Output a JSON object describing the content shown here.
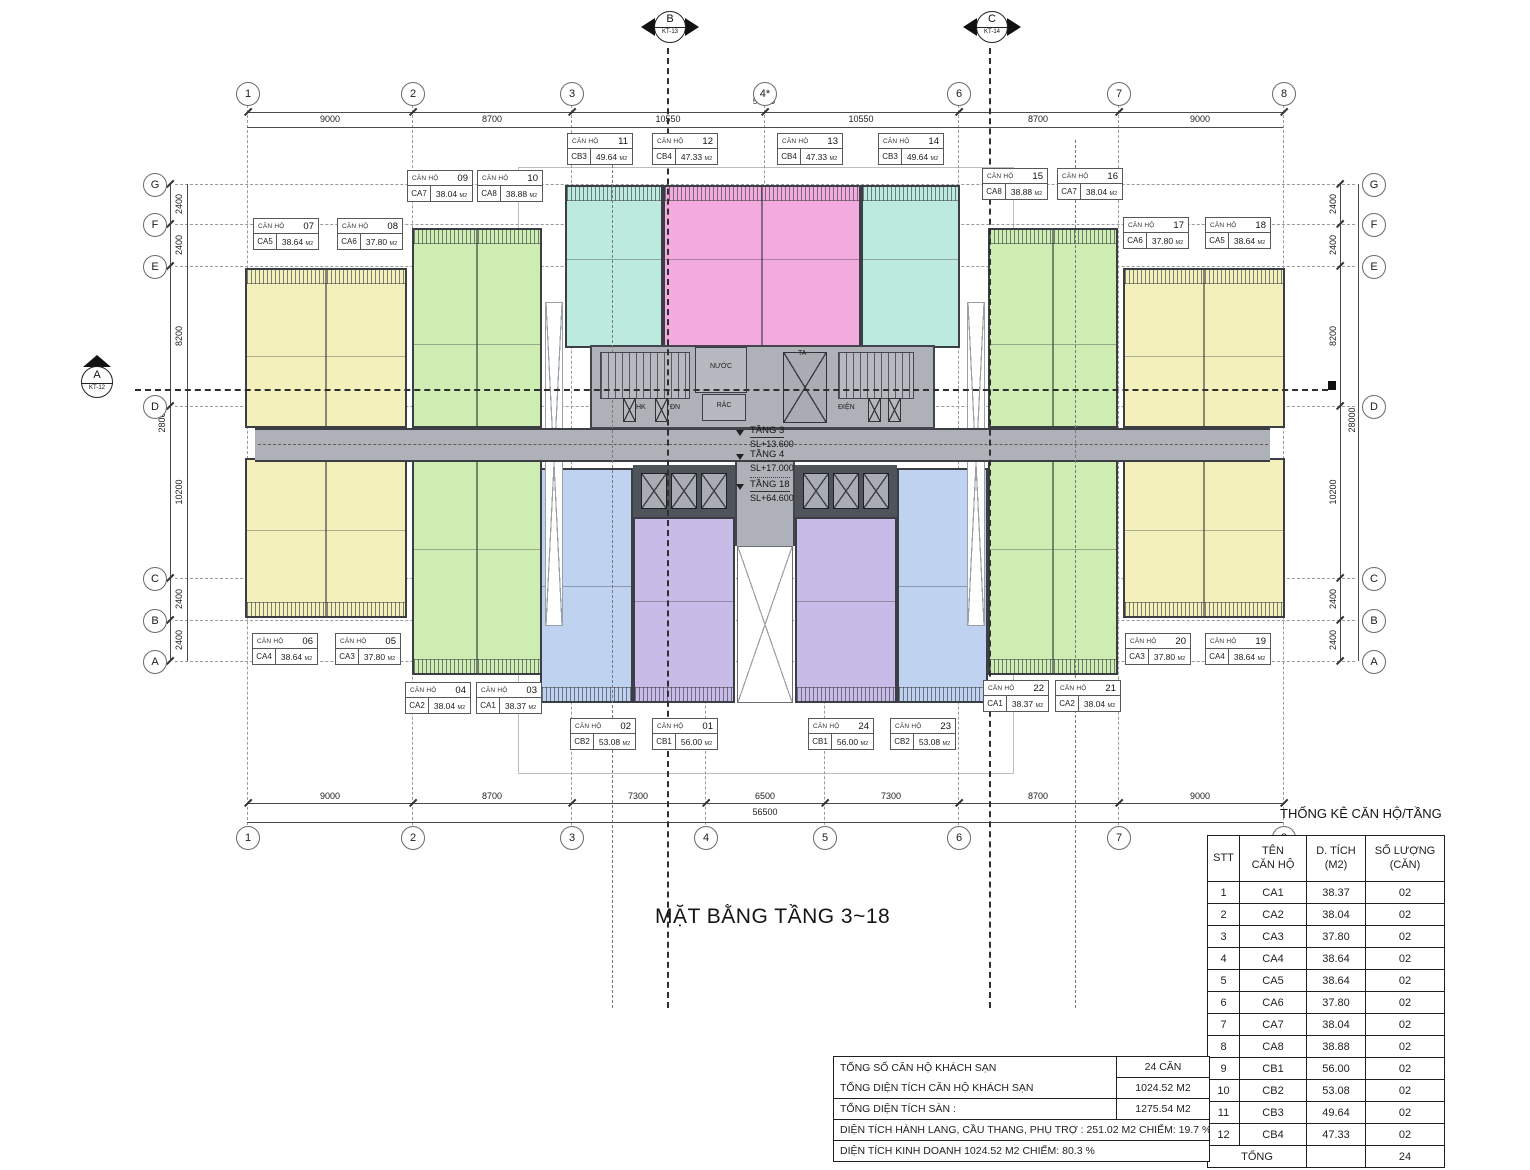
{
  "title": "MẶT BẰNG TẦNG 3~18",
  "section_markers": {
    "b": {
      "label": "B",
      "ref": "KT-13"
    },
    "c": {
      "label": "C",
      "ref": "KT-14"
    },
    "a": {
      "label": "A",
      "ref": "KT-12"
    }
  },
  "grid": {
    "top": [
      "1",
      "2",
      "3",
      "4*",
      "6",
      "7",
      "8"
    ],
    "bottom": [
      "1",
      "2",
      "3",
      "4",
      "5",
      "6",
      "7",
      "8"
    ],
    "left": [
      "G",
      "F",
      "E",
      "D",
      "C",
      "B",
      "A"
    ],
    "right": [
      "G",
      "F",
      "E",
      "D",
      "C",
      "B",
      "A"
    ]
  },
  "dims": {
    "top": [
      "9000",
      "8700",
      "10550",
      "10550",
      "8700",
      "9000"
    ],
    "top_total": "56500",
    "bottom": [
      "9000",
      "8700",
      "7300",
      "6500",
      "7300",
      "8700",
      "9000"
    ],
    "bottom_total": "56500",
    "left": [
      "2400",
      "2400",
      "8200",
      "10200",
      "2400",
      "2400"
    ],
    "left_total": "28000",
    "right": [
      "2400",
      "2400",
      "8200",
      "10200",
      "2400",
      "2400"
    ],
    "right_total": "28000"
  },
  "core": {
    "rooms": {
      "nuoc": "NƯỚC",
      "rac": "RÁC",
      "dn": "ĐN",
      "hk": "HK",
      "dien": "ĐIỆN",
      "ta": "TA"
    },
    "levels": [
      {
        "name": "TẦNG 3",
        "elev": "SL+13.600"
      },
      {
        "name": "TẦNG 4",
        "elev": "SL+17.000"
      },
      {
        "name": "TẦNG 18",
        "elev": "SL+64.600"
      }
    ]
  },
  "apartment_label_prefix": "CĂN HỘ",
  "area_unit": "M2",
  "apartments": [
    {
      "no": "01",
      "code": "CB1",
      "area": "56.00"
    },
    {
      "no": "02",
      "code": "CB2",
      "area": "53.08"
    },
    {
      "no": "03",
      "code": "CA1",
      "area": "38.37"
    },
    {
      "no": "04",
      "code": "CA2",
      "area": "38.04"
    },
    {
      "no": "05",
      "code": "CA3",
      "area": "37.80"
    },
    {
      "no": "06",
      "code": "CA4",
      "area": "38.64"
    },
    {
      "no": "07",
      "code": "CA5",
      "area": "38.64"
    },
    {
      "no": "08",
      "code": "CA6",
      "area": "37.80"
    },
    {
      "no": "09",
      "code": "CA7",
      "area": "38.04"
    },
    {
      "no": "10",
      "code": "CA8",
      "area": "38.88"
    },
    {
      "no": "11",
      "code": "CB3",
      "area": "49.64"
    },
    {
      "no": "12",
      "code": "CB4",
      "area": "47.33"
    },
    {
      "no": "13",
      "code": "CB4",
      "area": "47.33"
    },
    {
      "no": "14",
      "code": "CB3",
      "area": "49.64"
    },
    {
      "no": "15",
      "code": "CA8",
      "area": "38.88"
    },
    {
      "no": "16",
      "code": "CA7",
      "area": "38.04"
    },
    {
      "no": "17",
      "code": "CA6",
      "area": "37.80"
    },
    {
      "no": "18",
      "code": "CA5",
      "area": "38.64"
    },
    {
      "no": "19",
      "code": "CA4",
      "area": "38.64"
    },
    {
      "no": "20",
      "code": "CA3",
      "area": "37.80"
    },
    {
      "no": "21",
      "code": "CA2",
      "area": "38.04"
    },
    {
      "no": "22",
      "code": "CA1",
      "area": "38.37"
    },
    {
      "no": "23",
      "code": "CB2",
      "area": "53.08"
    },
    {
      "no": "24",
      "code": "CB1",
      "area": "56.00"
    }
  ],
  "stats_table": {
    "heading": "THỐNG KÊ CĂN HỘ/TẦNG",
    "headers": {
      "stt": "STT",
      "name1": "TÊN",
      "name2": "CĂN HỘ",
      "area1": "D. TÍCH",
      "area2": "(M2)",
      "qty1": "SỐ LƯỢNG",
      "qty2": "(CĂN)"
    },
    "rows": [
      {
        "stt": "1",
        "name": "CA1",
        "area": "38.37",
        "qty": "02"
      },
      {
        "stt": "2",
        "name": "CA2",
        "area": "38.04",
        "qty": "02"
      },
      {
        "stt": "3",
        "name": "CA3",
        "area": "37.80",
        "qty": "02"
      },
      {
        "stt": "4",
        "name": "CA4",
        "area": "38.64",
        "qty": "02"
      },
      {
        "stt": "5",
        "name": "CA5",
        "area": "38.64",
        "qty": "02"
      },
      {
        "stt": "6",
        "name": "CA6",
        "area": "37.80",
        "qty": "02"
      },
      {
        "stt": "7",
        "name": "CA7",
        "area": "38.04",
        "qty": "02"
      },
      {
        "stt": "8",
        "name": "CA8",
        "area": "38.88",
        "qty": "02"
      },
      {
        "stt": "9",
        "name": "CB1",
        "area": "56.00",
        "qty": "02"
      },
      {
        "stt": "10",
        "name": "CB2",
        "area": "53.08",
        "qty": "02"
      },
      {
        "stt": "11",
        "name": "CB3",
        "area": "49.64",
        "qty": "02"
      },
      {
        "stt": "12",
        "name": "CB4",
        "area": "47.33",
        "qty": "02"
      }
    ],
    "total_label": "TỔNG",
    "total_value": "24"
  },
  "summary_table": {
    "rows": [
      {
        "label": "TỔNG SỐ CĂN HỘ KHÁCH SẠN",
        "value": "24 CĂN"
      },
      {
        "label": "TỔNG DIỆN TÍCH CĂN HỘ KHÁCH SẠN",
        "value": "1024.52 M2"
      },
      {
        "label": "TỔNG DIỆN TÍCH SÀN :",
        "value": "1275.54 M2"
      },
      {
        "label": "DIỆN TÍCH HÀNH LANG, CẦU THANG, PHỤ TRỢ : 251.02 M2  CHIẾM:  19.7 %",
        "value": ""
      },
      {
        "label": "DIỆN TÍCH KINH DOANH 1024.52 M2  CHIẾM:  80.3 %",
        "value": ""
      }
    ]
  },
  "colors": {
    "yellow_unit": "#f4f0bc",
    "green_unit": "#cdedb2",
    "cyan_unit": "#bdeadf",
    "pink_unit": "#f3abdf",
    "blue_unit": "#bfd3f0",
    "purple_unit": "#c9bbe7",
    "core_gray": "#aeb1b7",
    "bank_dark": "#4f545a",
    "wall_dark": "#3b3f45"
  }
}
